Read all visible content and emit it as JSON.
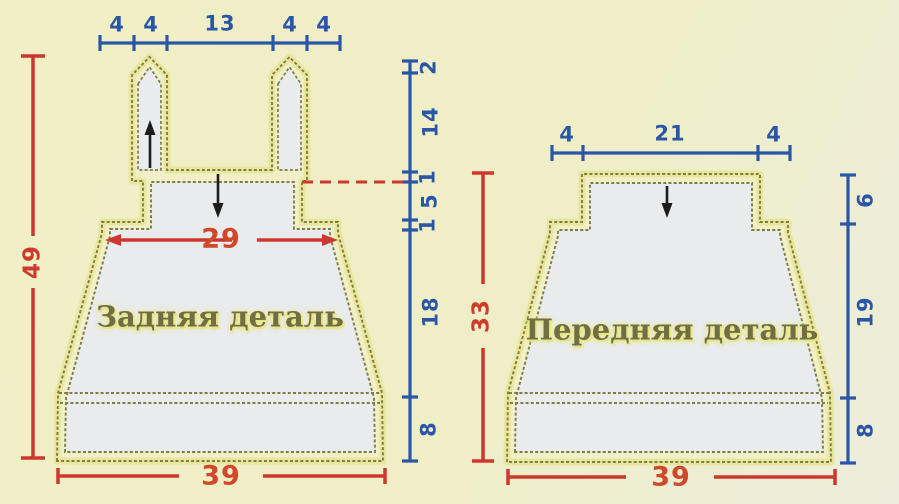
{
  "diagram_title": "knitting-pattern-schematic",
  "left_piece": {
    "name": "Задняя деталь",
    "top_widths": [
      "4",
      "4",
      "13",
      "4",
      "4"
    ],
    "side_heights": [
      "2",
      "14",
      "1",
      "5",
      "1",
      "18",
      "8"
    ],
    "total_height": "49",
    "chest_width": "29",
    "bottom_width": "39"
  },
  "right_piece": {
    "name": "Передняя деталь",
    "top_widths": [
      "4",
      "21",
      "4"
    ],
    "side_heights": [
      "6",
      "19",
      "8"
    ],
    "total_height": "33",
    "bottom_width": "39"
  },
  "colors": {
    "dimension_blue": "#2a56a7",
    "dimension_red": "#ce3b2d",
    "outline_olive": "#7c7c44",
    "piece_fill": "#e9ebec",
    "piece_margin_fill": "#f1efc8",
    "background": "#f0eec7",
    "label_olive": "#6f6e45"
  }
}
